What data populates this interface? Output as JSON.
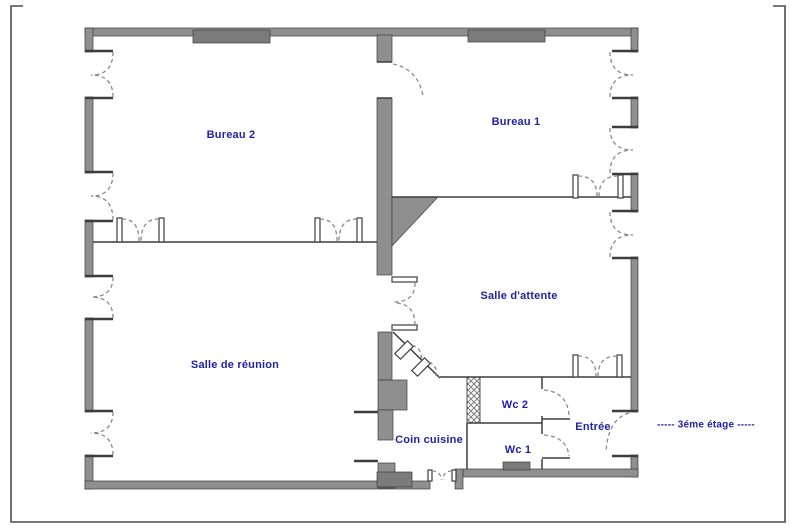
{
  "labels": {
    "bureau_2": "Bureau 2",
    "bureau_1": "Bureau 1",
    "salle_attente": "Salle d'attente",
    "salle_reunion": "Salle de réunion",
    "coin_cuisine": "Coin cuisine",
    "wc_2": "Wc 2",
    "wc_1": "Wc 1",
    "entree": "Entrée",
    "floor_note": "-----  3éme étage  -----"
  },
  "colors": {
    "bg": "#ffffff",
    "wall": "#8f8f8f",
    "wall_dark": "#7b7b7b",
    "line": "#3d3d3d",
    "arc": "#8a8a8a",
    "label": "#2122a6",
    "frame": "#4d4d4d"
  }
}
